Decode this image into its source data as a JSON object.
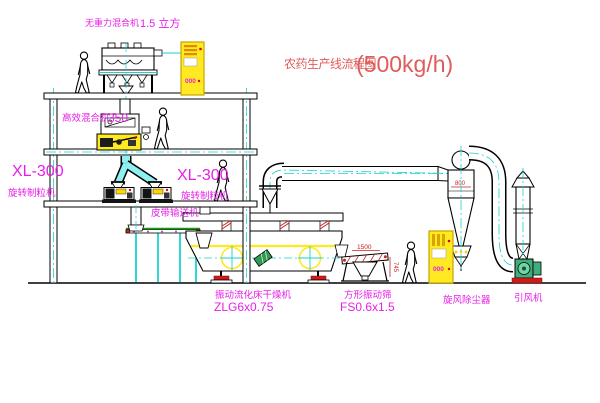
{
  "title": {
    "name": "农药生产线流程图",
    "capacity": "(500kg/h)"
  },
  "colors": {
    "label_magenta": "#e81ee8",
    "title_red": "#e05c5c",
    "cad_yellow": "#ffe920",
    "cad_cyan": "#1ad1d1",
    "conveyor_green": "#00aa00",
    "dimension_red": "#cc2222"
  },
  "equipment": {
    "gravity_mixer": {
      "name": "无重力混合机",
      "size": "1.5 立方"
    },
    "high_eff_mixer": {
      "name": "高效混合机",
      "size": "350"
    },
    "granulator_left": {
      "model": "XL-300",
      "name": "旋转制粒机"
    },
    "granulator_right": {
      "model": "XL-300",
      "name": "旋转制粒机"
    },
    "belt_conveyor": {
      "name": "皮带输送机"
    },
    "fluid_bed_dryer": {
      "name": "振动流化床干燥机",
      "model": "ZLG6x0.75"
    },
    "vibrating_screen": {
      "name": "方形振动筛",
      "model": "FS0.6x1.5"
    },
    "cyclone_collector": {
      "name": "旋风除尘器"
    },
    "induced_draft_fan": {
      "name": "引风机"
    }
  },
  "dimensions": {
    "cyclone_width": "800",
    "screen_length": "1500",
    "screen_height": "745"
  },
  "cabinet": {
    "display": "000"
  }
}
